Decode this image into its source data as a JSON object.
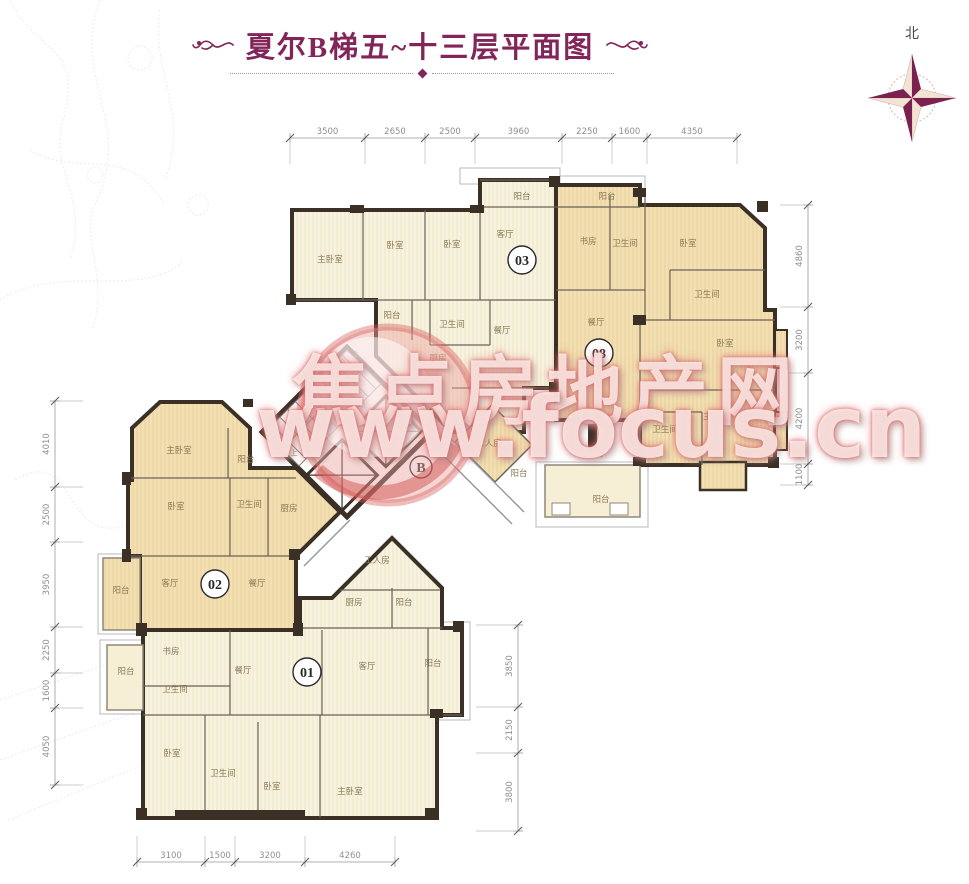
{
  "page": {
    "title": "夏尔B梯五~十三层平面图",
    "compass_label": "北"
  },
  "watermark": {
    "line1": "焦点房地产网",
    "line2": "www.focus.cn"
  },
  "plan": {
    "unit_badges": [
      {
        "label": "01",
        "x": 307,
        "y": 672,
        "r": 14
      },
      {
        "label": "02",
        "x": 215,
        "y": 584,
        "r": 14
      },
      {
        "label": "03",
        "x": 522,
        "y": 260,
        "r": 14
      },
      {
        "label": "08",
        "x": 599,
        "y": 353,
        "r": 14
      },
      {
        "label": "B",
        "x": 421,
        "y": 467,
        "r": 11
      }
    ],
    "room_labels": [
      {
        "label": "主卧室",
        "x": 330,
        "y": 262
      },
      {
        "label": "卧室",
        "x": 395,
        "y": 248
      },
      {
        "label": "卧室",
        "x": 452,
        "y": 247
      },
      {
        "label": "客厅",
        "x": 505,
        "y": 237
      },
      {
        "label": "阳台",
        "x": 522,
        "y": 199
      },
      {
        "label": "阳台",
        "x": 392,
        "y": 318
      },
      {
        "label": "卫生间",
        "x": 452,
        "y": 327
      },
      {
        "label": "餐厅",
        "x": 502,
        "y": 333
      },
      {
        "label": "厨房",
        "x": 438,
        "y": 361
      },
      {
        "label": "阳台",
        "x": 607,
        "y": 199
      },
      {
        "label": "书房",
        "x": 588,
        "y": 244
      },
      {
        "label": "卫生间",
        "x": 625,
        "y": 246
      },
      {
        "label": "卧室",
        "x": 688,
        "y": 246
      },
      {
        "label": "卫生间",
        "x": 707,
        "y": 297
      },
      {
        "label": "餐厅",
        "x": 596,
        "y": 325
      },
      {
        "label": "卧室",
        "x": 725,
        "y": 346
      },
      {
        "label": "主卧室",
        "x": 716,
        "y": 419
      },
      {
        "label": "卫生间",
        "x": 665,
        "y": 432
      },
      {
        "label": "客厅",
        "x": 597,
        "y": 456
      },
      {
        "label": "阳台",
        "x": 601,
        "y": 502
      },
      {
        "label": "工人房",
        "x": 489,
        "y": 446
      },
      {
        "label": "阳台",
        "x": 519,
        "y": 476
      },
      {
        "label": "上",
        "x": 356,
        "y": 356,
        "s": 7
      },
      {
        "label": "上",
        "x": 294,
        "y": 455,
        "s": 7
      },
      {
        "label": "主卧室",
        "x": 179,
        "y": 453
      },
      {
        "label": "阳台",
        "x": 246,
        "y": 462
      },
      {
        "label": "卧室",
        "x": 176,
        "y": 509
      },
      {
        "label": "卫生间",
        "x": 249,
        "y": 507
      },
      {
        "label": "厨房",
        "x": 289,
        "y": 511
      },
      {
        "label": "客厅",
        "x": 170,
        "y": 586
      },
      {
        "label": "餐厅",
        "x": 257,
        "y": 586
      },
      {
        "label": "阳台",
        "x": 121,
        "y": 593
      },
      {
        "label": "工人房",
        "x": 377,
        "y": 563
      },
      {
        "label": "厨房",
        "x": 354,
        "y": 605
      },
      {
        "label": "阳台",
        "x": 404,
        "y": 605
      },
      {
        "label": "书房",
        "x": 171,
        "y": 654
      },
      {
        "label": "阳台",
        "x": 126,
        "y": 674
      },
      {
        "label": "卫生间",
        "x": 175,
        "y": 692
      },
      {
        "label": "餐厅",
        "x": 243,
        "y": 673
      },
      {
        "label": "客厅",
        "x": 367,
        "y": 669
      },
      {
        "label": "阳台",
        "x": 433,
        "y": 666
      },
      {
        "label": "卧室",
        "x": 172,
        "y": 756
      },
      {
        "label": "卫生间",
        "x": 223,
        "y": 776
      },
      {
        "label": "卧室",
        "x": 272,
        "y": 789
      },
      {
        "label": "主卧室",
        "x": 350,
        "y": 794
      }
    ]
  },
  "dimensions": {
    "top": {
      "orientation": "h",
      "line": 138,
      "ticks": [
        290,
        365,
        425,
        475,
        562,
        612,
        647,
        737
      ],
      "values": [
        "3500",
        "2650",
        "2500",
        "3960",
        "2250",
        "1600",
        "4350"
      ]
    },
    "bottom": {
      "orientation": "h",
      "line": 862,
      "ticks": [
        137,
        205,
        235,
        305,
        395
      ],
      "values": [
        "3100",
        "1500",
        "3200",
        "4260"
      ]
    },
    "left": {
      "orientation": "v",
      "line": 55,
      "ticks": [
        401,
        487,
        542,
        627,
        673,
        708,
        785
      ],
      "values": [
        "4010",
        "2500",
        "3950",
        "2250",
        "1600",
        "4050"
      ]
    },
    "right": {
      "orientation": "v",
      "line": 808,
      "ticks": [
        205,
        307,
        373,
        464,
        485
      ],
      "values": [
        "4860",
        "3200",
        "4200",
        "1100"
      ]
    },
    "mid_right": {
      "orientation": "v",
      "line": 518,
      "ticks": [
        625,
        707,
        753,
        831
      ],
      "values": [
        "3850",
        "2150",
        "3800"
      ]
    }
  },
  "colors": {
    "title": "#82265a",
    "wall": "#3b3026",
    "unit_cream": "#f8f3e0",
    "unit_tan": "#f3dfb2",
    "room_text": "#8a7a56",
    "dim_text": "#8f8f8f",
    "watermark_pink": "#eba4a0",
    "compass_dark": "#7b2150",
    "compass_light": "#f3e3d3"
  }
}
